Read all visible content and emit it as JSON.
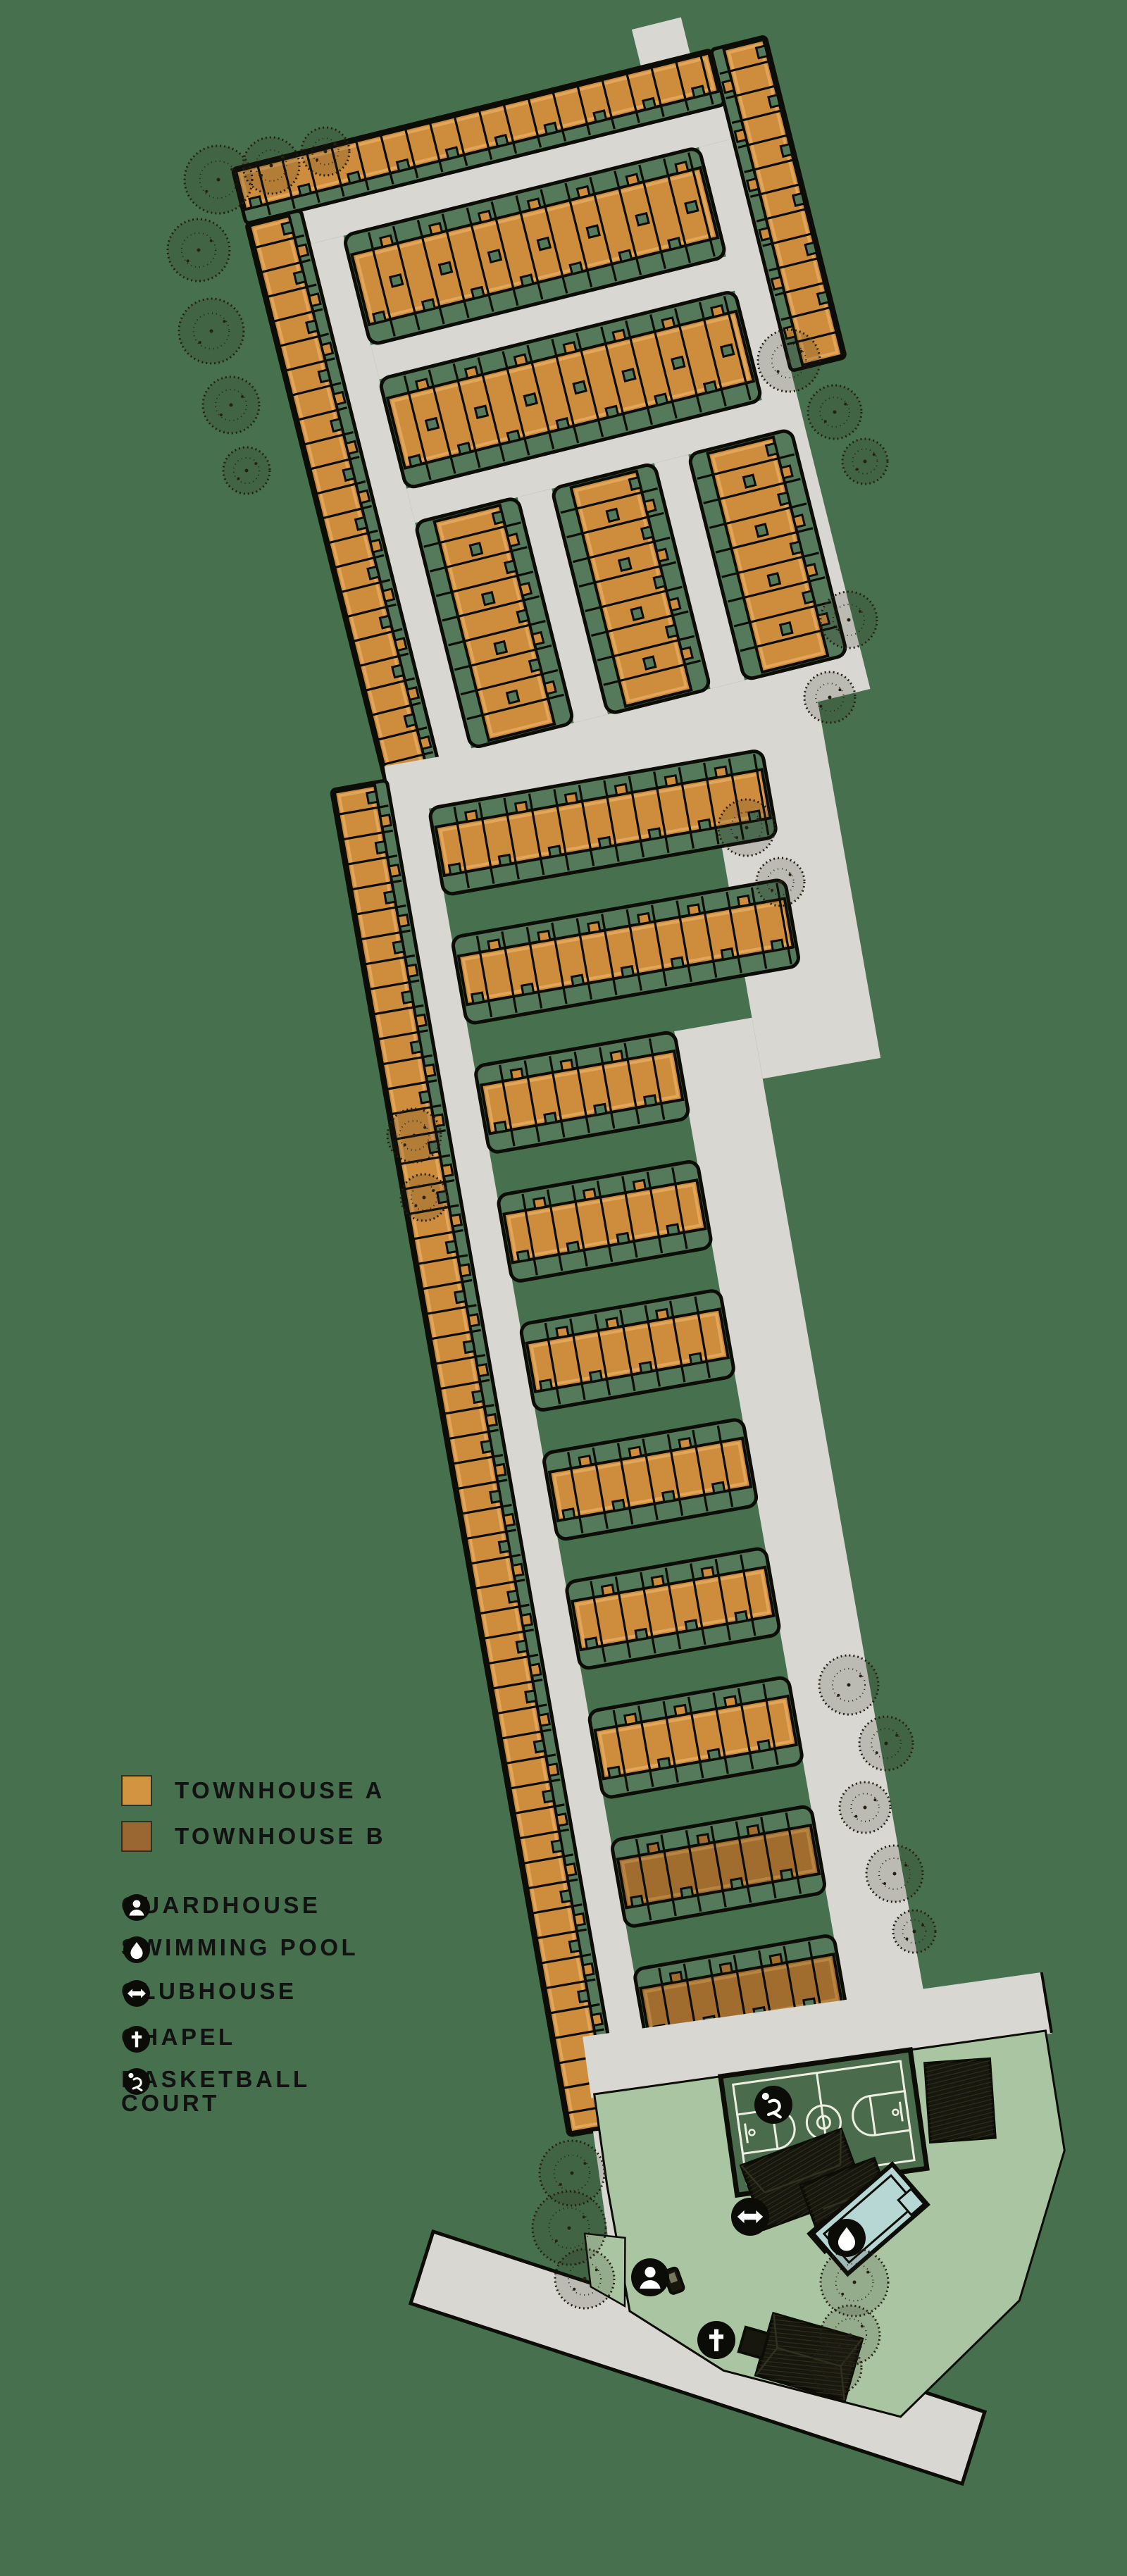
{
  "title": "Townhouse community site development plan",
  "legend": {
    "townhouse_a_label": "TOWNHOUSE A",
    "townhouse_b_label": "TOWNHOUSE B",
    "amenities": [
      {
        "icon": "person-icon",
        "label": "GUARDHOUSE"
      },
      {
        "icon": "droplet-icon",
        "label": "SWIMMING POOL"
      },
      {
        "icon": "double-arrow-icon",
        "label": "CLUBHOUSE"
      },
      {
        "icon": "cross-icon",
        "label": "CHAPEL"
      },
      {
        "icon": "basketball-player-icon",
        "label": "BASKETBALL",
        "label2": "COURT"
      }
    ]
  },
  "map_features": {
    "markers": [
      {
        "name": "basketball-court-marker",
        "icon": "basketball-player-icon"
      },
      {
        "name": "clubhouse-marker",
        "icon": "double-arrow-icon"
      },
      {
        "name": "swimming-pool-marker",
        "icon": "droplet-icon"
      },
      {
        "name": "chapel-marker",
        "icon": "cross-icon"
      },
      {
        "name": "guardhouse-marker",
        "icon": "person-icon"
      }
    ]
  },
  "colors": {
    "background": "#47704E",
    "road": "#D8D7D1",
    "block_green": "#55795B",
    "lot_line": "#0D0D08",
    "townhouse_a": "#CE8D3D",
    "townhouse_a_light": "#E2A65A",
    "townhouse_b": "#A16D2F",
    "townhouse_b_light": "#B78441",
    "legend_swatch_a": "#D29440",
    "legend_swatch_b": "#9A6732",
    "lawn": "#AAC5A2",
    "court": "#4B6C4C",
    "court_line": "#EDEFE2",
    "pool": "#B7D7D5",
    "roof": "#17170E",
    "roof_hatch": "#31311F",
    "icon_bg": "#0B0B07",
    "icon_glyph": "#FFFFFF",
    "tree": "#262012",
    "text": "#121212"
  }
}
